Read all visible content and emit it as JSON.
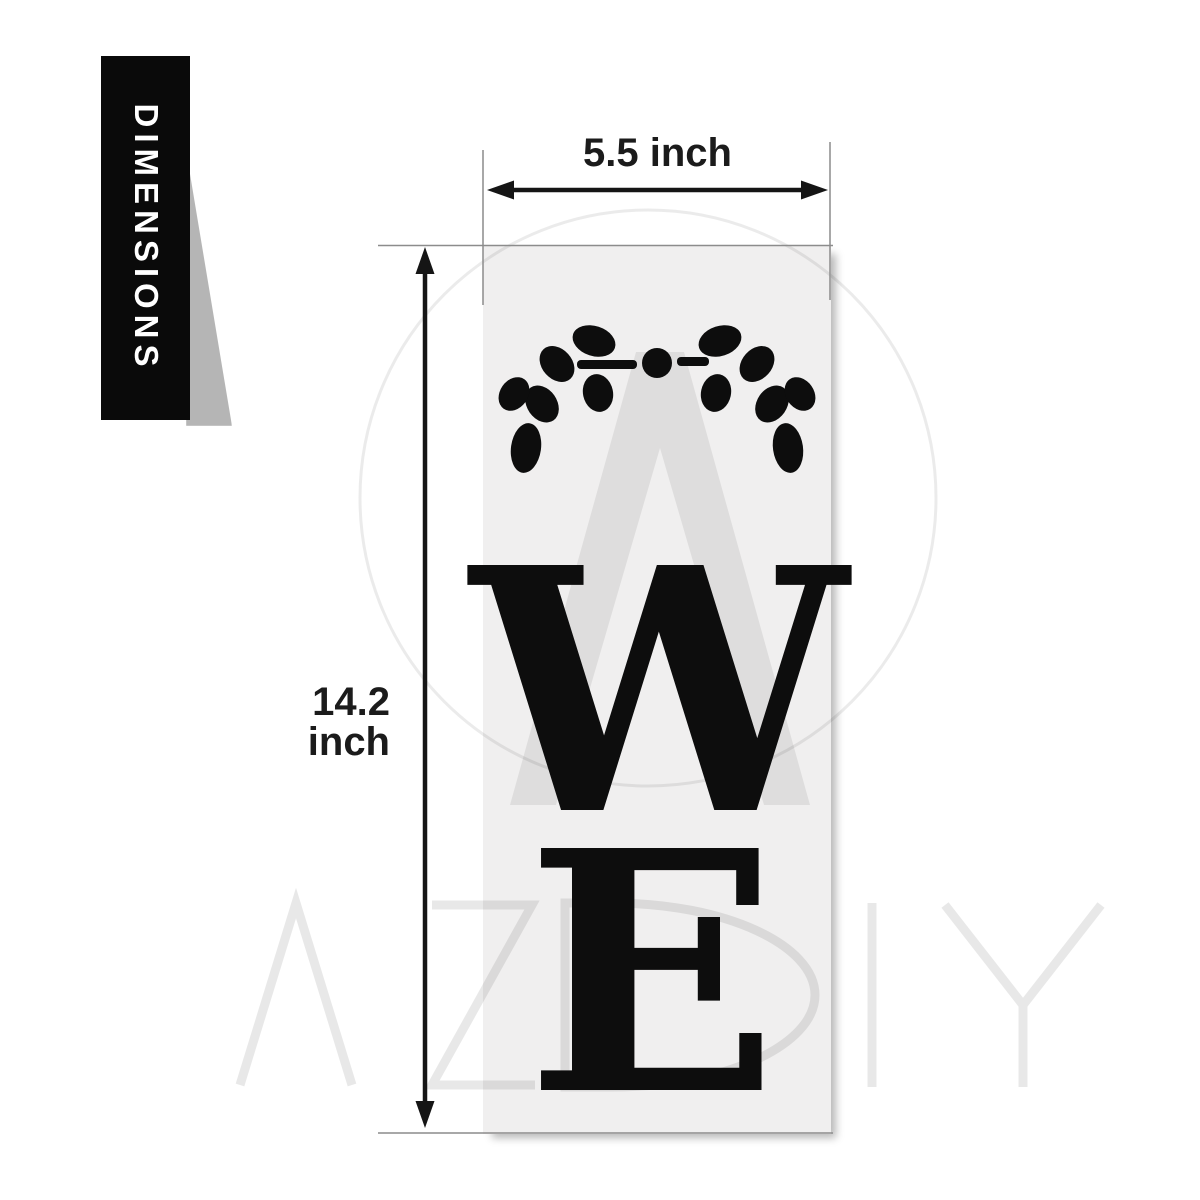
{
  "badge": {
    "label": "DIMENSIONS"
  },
  "dimensions": {
    "width_label": "5.5 inch",
    "height_label": "14.2 inch"
  },
  "stencil": {
    "letter_top": "W",
    "letter_bottom": "E",
    "decoration": "laurel-sprig-with-center-dot",
    "panel_color": "#f0efef"
  },
  "watermark": {
    "brand": "AZDIY",
    "logo": "circle-with-A-monogram"
  },
  "colors": {
    "ink": "#0d0d0d",
    "banner_bg": "#0a0a0a",
    "banner_text": "#ffffff",
    "extension_line": "#8c8c8c",
    "panel": "#f0efef",
    "fold_shadow": "#b5b5b5"
  }
}
